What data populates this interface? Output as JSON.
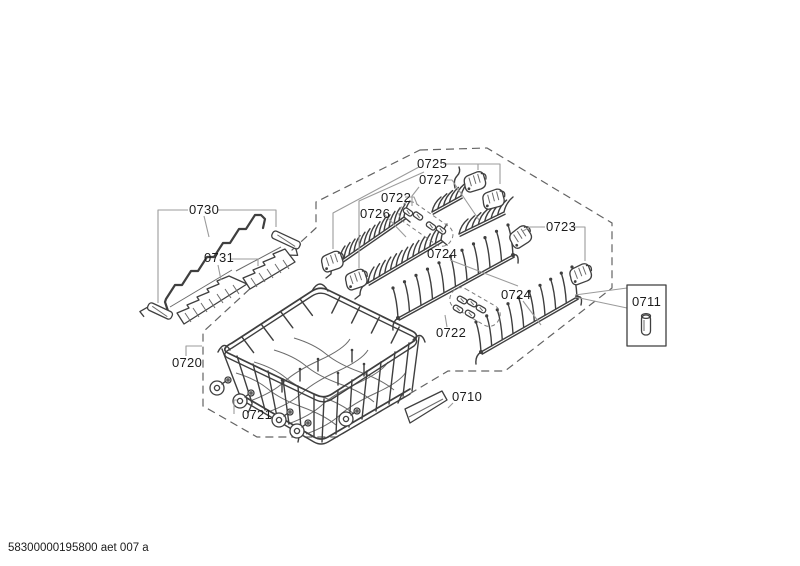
{
  "document": {
    "type": "exploded-parts-diagram",
    "footer": {
      "doc_code": "58300000195800 aet 007 a"
    },
    "labels": {
      "p0710": "0710",
      "p0711": "0711",
      "p0720": "0720",
      "p0721": "0721",
      "p0722_upper": "0722",
      "p0722_lower": "0722",
      "p0723": "0723",
      "p0724_upper": "0724",
      "p0724_lower": "0724",
      "p0725": "0725",
      "p0726": "0726",
      "p0727": "0727",
      "p0730": "0730",
      "p0731": "0731"
    },
    "colors": {
      "background": "#ffffff",
      "part_stroke": "#3f3f3f",
      "leader_line": "#9b9b9b",
      "dashed_boundary": "#636363",
      "label_text": "#1c1c1c"
    }
  }
}
